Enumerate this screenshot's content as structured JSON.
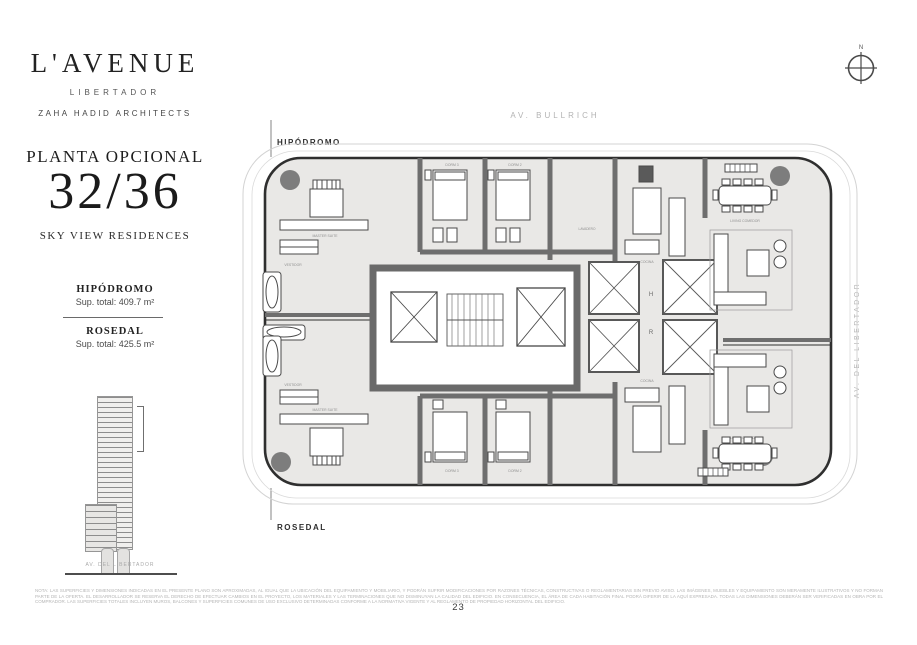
{
  "brand": {
    "name": "L'AVENUE",
    "sub": "LIBERTADOR",
    "architects": "ZAHA HADID ARCHITECTS"
  },
  "plan_header": {
    "title": "PLANTA OPCIONAL",
    "floors": "32/36",
    "subtitle": "SKY VIEW RESIDENCES"
  },
  "units": [
    {
      "name": "HIPÓDROMO",
      "area": "Sup. total: 409.7 m²"
    },
    {
      "name": "ROSEDAL",
      "area": "Sup. total: 425.5 m²"
    }
  ],
  "elevation": {
    "caption": "AV. DEL LIBERTADOR"
  },
  "compass": {
    "north_label": "N"
  },
  "plan": {
    "street_top": "AV. BULLRICH",
    "street_right": "AV. DEL LIBERTADOR",
    "unit_top_label": "HIPÓDROMO",
    "unit_bottom_label": "ROSEDAL",
    "elevator_labels": {
      "h": "H",
      "r": "R"
    },
    "room_labels": {
      "master_suite": "MASTER SUITE",
      "vestidor": "VESTIDOR",
      "dorm_2": "DORM 2",
      "dorm_3": "DORM 3",
      "cocina": "COCINA",
      "lavadero": "LAVADERO",
      "living_comedor": "LIVING COMEDOR"
    }
  },
  "footer": {
    "page_number": "23",
    "disclaimer": "NOTA: LAS SUPERFICIES Y DIMENSIONES INDICADAS EN EL PRESENTE PLANO SON APROXIMADAS, AL IGUAL QUE LA UBICACIÓN DEL EQUIPAMIENTO Y MOBILIARIO, Y PODRÁN SUFRIR MODIFICACIONES POR RAZONES TÉCNICAS, CONSTRUCTIVAS O REGLAMENTARIAS SIN PREVIO AVISO. LAS IMÁGENES, MUEBLES Y EQUIPAMIENTO SON MERAMENTE ILUSTRATIVOS Y NO FORMAN PARTE DE LA OFERTA. EL DESARROLLADOR SE RESERVA EL DERECHO DE EFECTUAR CAMBIOS EN EL PROYECTO, LOS MATERIALES Y LAS TERMINACIONES QUE NO DISMINUYAN LA CALIDAD DEL EDIFICIO. EN CONSECUENCIA, EL ÁREA DE CADA HABITACIÓN FINAL PODRÁ DIFERIR DE LA AQUÍ EXPRESADA. TODAS LAS DIMENSIONES DEBERÁN SER VERIFICADAS EN OBRA POR EL COMPRADOR. LAS SUPERFICIES TOTALES INCLUYEN MUROS, BALCONES Y SUPERFICIES COMUNES DE USO EXCLUSIVO DETERMINADAS CONFORME A LA NORMATIVA VIGENTE Y AL REGLAMENTO DE PROPIEDAD HORIZONTAL DEL EDIFICIO."
  }
}
